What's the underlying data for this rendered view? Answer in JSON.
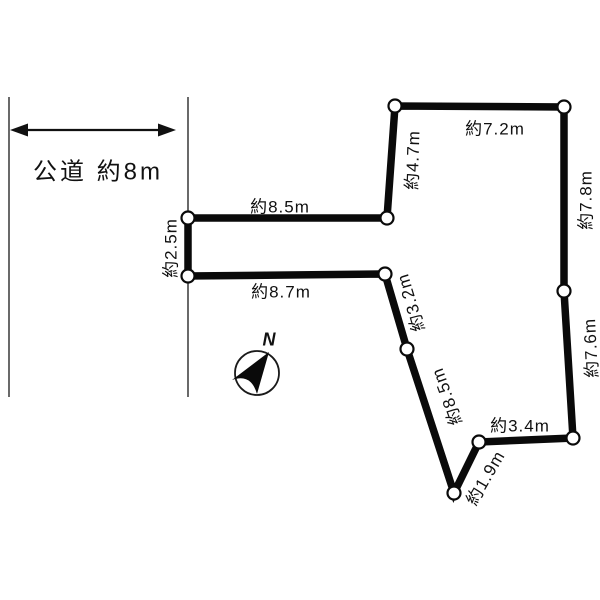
{
  "road": {
    "label": "公道 約8m"
  },
  "compass": {
    "north_label": "N"
  },
  "plot": {
    "outline_color": "#000000",
    "vertices": [
      {
        "x": 188,
        "y": 218
      },
      {
        "x": 387,
        "y": 218
      },
      {
        "x": 395,
        "y": 106
      },
      {
        "x": 564,
        "y": 107
      },
      {
        "x": 564,
        "y": 291
      },
      {
        "x": 573,
        "y": 438
      },
      {
        "x": 479,
        "y": 442
      },
      {
        "x": 454,
        "y": 493
      },
      {
        "x": 407,
        "y": 349
      },
      {
        "x": 385,
        "y": 274
      },
      {
        "x": 188,
        "y": 276
      }
    ],
    "edges": [
      {
        "from": 0,
        "to": 1,
        "length_label": "約8.5m"
      },
      {
        "from": 1,
        "to": 2,
        "length_label": "約4.7m"
      },
      {
        "from": 2,
        "to": 3,
        "length_label": "約7.2m"
      },
      {
        "from": 3,
        "to": 4,
        "length_label": "約7.8m"
      },
      {
        "from": 4,
        "to": 5,
        "length_label": "約7.6m"
      },
      {
        "from": 5,
        "to": 6,
        "length_label": "約3.4m"
      },
      {
        "from": 6,
        "to": 7,
        "length_label": "約1.9m"
      },
      {
        "from": 7,
        "to": 8,
        "length_label": "約8.5m"
      },
      {
        "from": 8,
        "to": 9,
        "length_label": "約3.2m"
      },
      {
        "from": 9,
        "to": 10,
        "length_label": "約8.7m"
      },
      {
        "from": 10,
        "to": 0,
        "length_label": "約2.5m"
      }
    ]
  }
}
